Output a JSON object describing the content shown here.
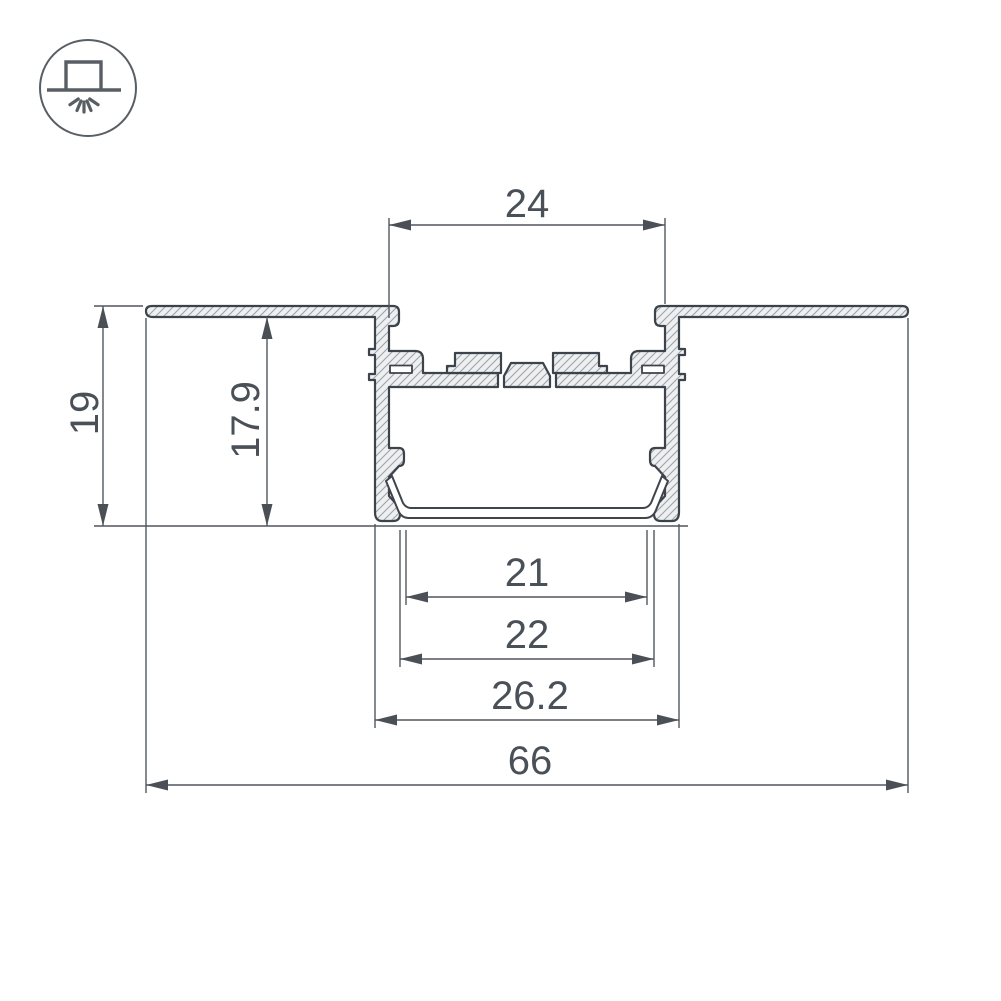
{
  "drawing": {
    "icon_meaning": "recessed-ceiling-light-mounting",
    "dims": {
      "top_opening": "24",
      "recess_depth": "19",
      "inner_depth": "17.9",
      "lens_inner_width": "21",
      "lens_outer_width": "22",
      "body_width": "26.2",
      "flange_width": "66"
    },
    "colors": {
      "outline": "#3d434b",
      "dimension_lines": "#51575e",
      "dimension_text": "#4a5057",
      "hatch_lines": "#9aa0a6",
      "section_fill": "#edeff0",
      "background": "#ffffff"
    }
  }
}
